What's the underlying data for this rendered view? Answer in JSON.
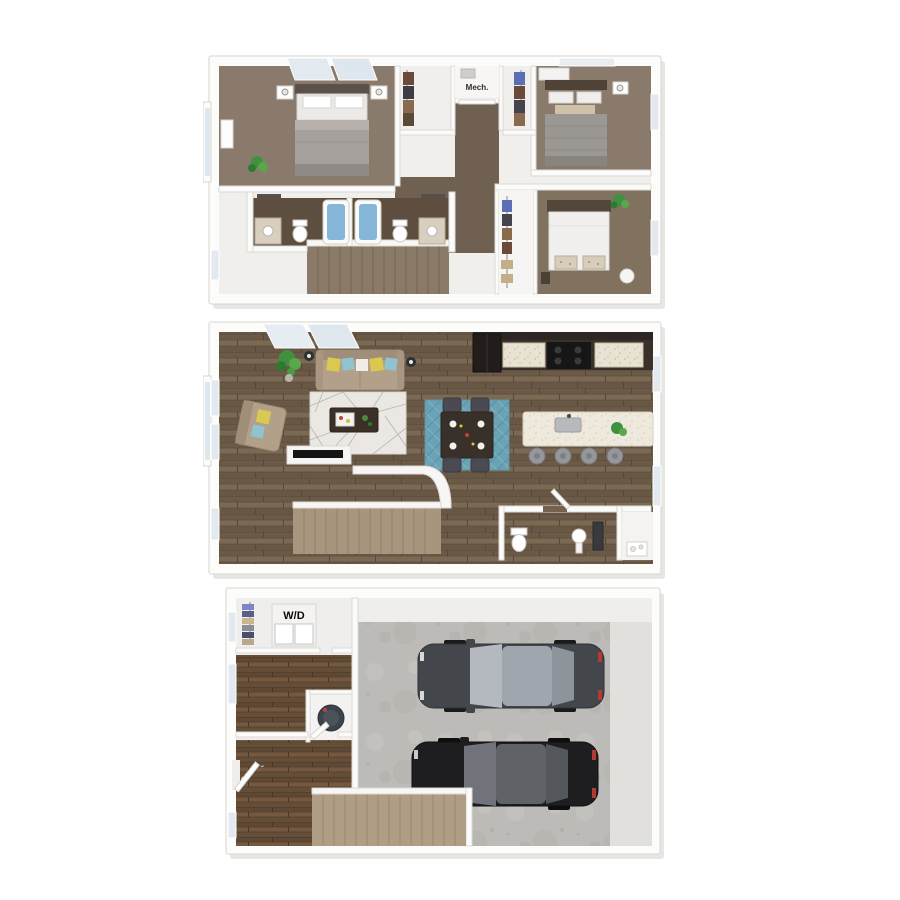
{
  "image": {
    "kind": "stacked-3d-floor-plans",
    "floor_count": 3,
    "background": "#ffffff"
  },
  "labels": {
    "mech": "Mech.",
    "wd": "W/D"
  },
  "palette": {
    "wall": "#fcfcfb",
    "wall_edge": "#d9d6d2",
    "carpet": "#897a6b",
    "hall_carpet": "#6f6051",
    "bath_floor": "#5e4e3f",
    "wood_main": "#73624f",
    "wood_entry": "#6a523d",
    "concrete": "#bdbbb7",
    "tub_water": "#84b7d8",
    "rug_living": "#ebe8e3",
    "rug_dining": "#6aa2b6",
    "sofa_beige": "#b2a08a",
    "pillow_yellow": "#d9c94f",
    "pillow_teal": "#8fc3d0",
    "kitchen_cabinet": "#393129",
    "island_top": "#eee9dc",
    "stair_tan": "#b09d85",
    "stair_upper": "#8a7a68",
    "car_dark_gray": "#43464b",
    "car_black": "#1e1e21",
    "car_glass": "#b3b9bf",
    "plant_green": "#3f9140",
    "bed_gray": "#a6a19c",
    "bed_white": "#f1f0ee",
    "headboard": "#57493c"
  },
  "floors": [
    {
      "id": "upper",
      "areas": [
        "bedroom-1",
        "bedroom-2",
        "bedroom-3",
        "bathroom-1",
        "bathroom-2",
        "walk-in-closet",
        "closet",
        "mech-closet",
        "hallway",
        "stairs"
      ]
    },
    {
      "id": "main",
      "areas": [
        "living-room",
        "dining-area",
        "kitchen",
        "island-peninsula",
        "powder-room",
        "closet",
        "stairs"
      ]
    },
    {
      "id": "garage",
      "areas": [
        "two-car-garage",
        "laundry-closet",
        "water-heater-closet",
        "hallway",
        "entry",
        "stairs"
      ]
    }
  ]
}
